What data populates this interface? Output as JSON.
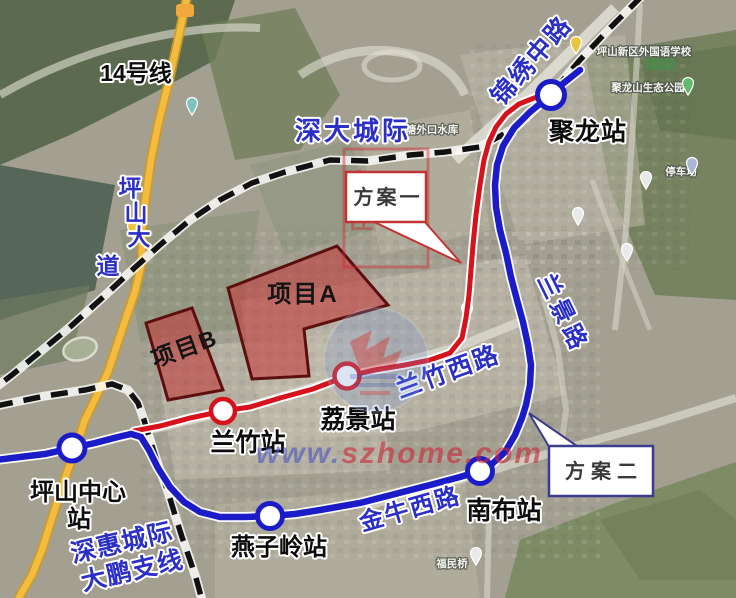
{
  "map_overlay": {
    "metro_line14_label": "14号线",
    "shenda_intercity_label": "深大城际",
    "shenhui_intercity_line1": "深惠城际",
    "shenhui_intercity_line2": "大鹏支线",
    "plan1_label": "方案一",
    "plan2_label": "方案二",
    "project_a_label": "项目A",
    "project_b_label": "项目B"
  },
  "stations": {
    "julong": "聚龙站",
    "lijing": "荔景站",
    "lanzhu": "兰竹站",
    "pingshan_center_line1": "坪山中心",
    "pingshan_center_line2": "站",
    "yanziling": "燕子岭站",
    "nanbu": "南布站"
  },
  "roads": {
    "jinxiu_middle_road": "锦绣中路",
    "lanzhu_west_road": "兰竹西路",
    "lanjing_road": "兰景路",
    "jinniu_west_road": "金牛西路",
    "pingshan_avenue_chars": [
      "坪",
      "山",
      "大",
      "道"
    ]
  },
  "basemap_pois": {
    "school": "坪山新区外国语学校",
    "park": "聚龙山生态公园",
    "parking_lot": "停车场",
    "reservoir": "塘外口水库",
    "bridge": "福民桥"
  },
  "watermark": {
    "url_www": "www.",
    "url_domain": "szhome",
    "url_tld": ".com",
    "stamp_chars": [
      "家",
      "在",
      "深",
      "圳"
    ]
  },
  "colors": {
    "plan1_route_red": "#d6131c",
    "plan2_route_blue": "#1b1cc8",
    "boundary_black": "#111111",
    "road_yellow": "#f3bc3f",
    "road_label_blue": "#2b2fc6",
    "plan1_box_border": "#c03434",
    "plan2_box_border": "#3c3c8e",
    "project_area_fill": "#c23b3b"
  }
}
